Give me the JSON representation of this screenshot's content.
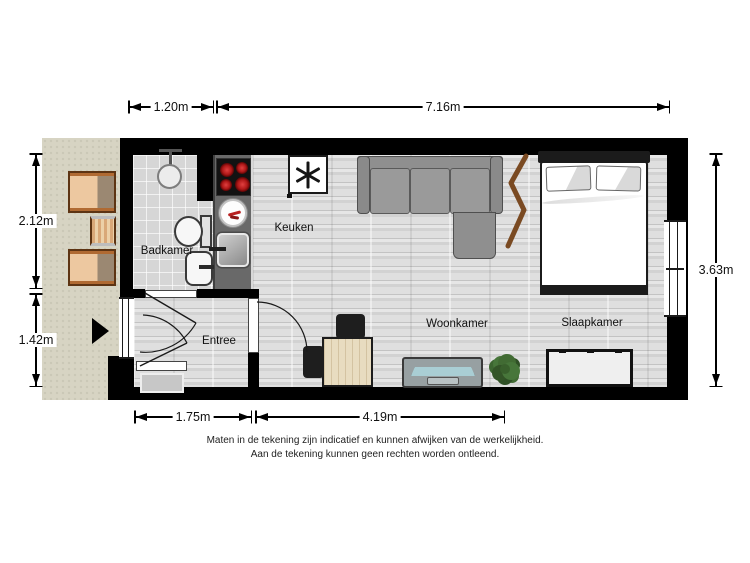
{
  "plan": {
    "rooms": {
      "badkamer": "Badkamer",
      "keuken": "Keuken",
      "entree": "Entree",
      "woonkamer": "Woonkamer",
      "slaapkamer": "Slaapkamer"
    },
    "dimensions": {
      "top_small": "1.20m",
      "top_large": "7.16m",
      "left_top": "2.12m",
      "left_bottom": "1.42m",
      "right_side": "3.63m",
      "bottom_small": "1.75m",
      "bottom_large": "4.19m"
    },
    "disclaimer": {
      "line1": "Maten in de tekening zijn indicatief en kunnen afwijken van de werkelijkheid.",
      "line2": "Aan de tekening kunnen geen rechten worden ontleend."
    },
    "icons": {
      "freezer_symbol": "six-spoke-asterisk",
      "entrance_arrow": "right-pointing-triangle"
    },
    "colors": {
      "wall": "#000000",
      "floor": "#d8d8d8",
      "balcony": "#d7d4c3",
      "counter": "#696969",
      "burner_red": "#c22222",
      "tv_screen": "#a9ced4",
      "plant_green": "#416b33",
      "wood_furniture": "#e8dcc0",
      "balcony_chair": "#edc8a0",
      "divider_brown": "#7a4a22"
    }
  }
}
